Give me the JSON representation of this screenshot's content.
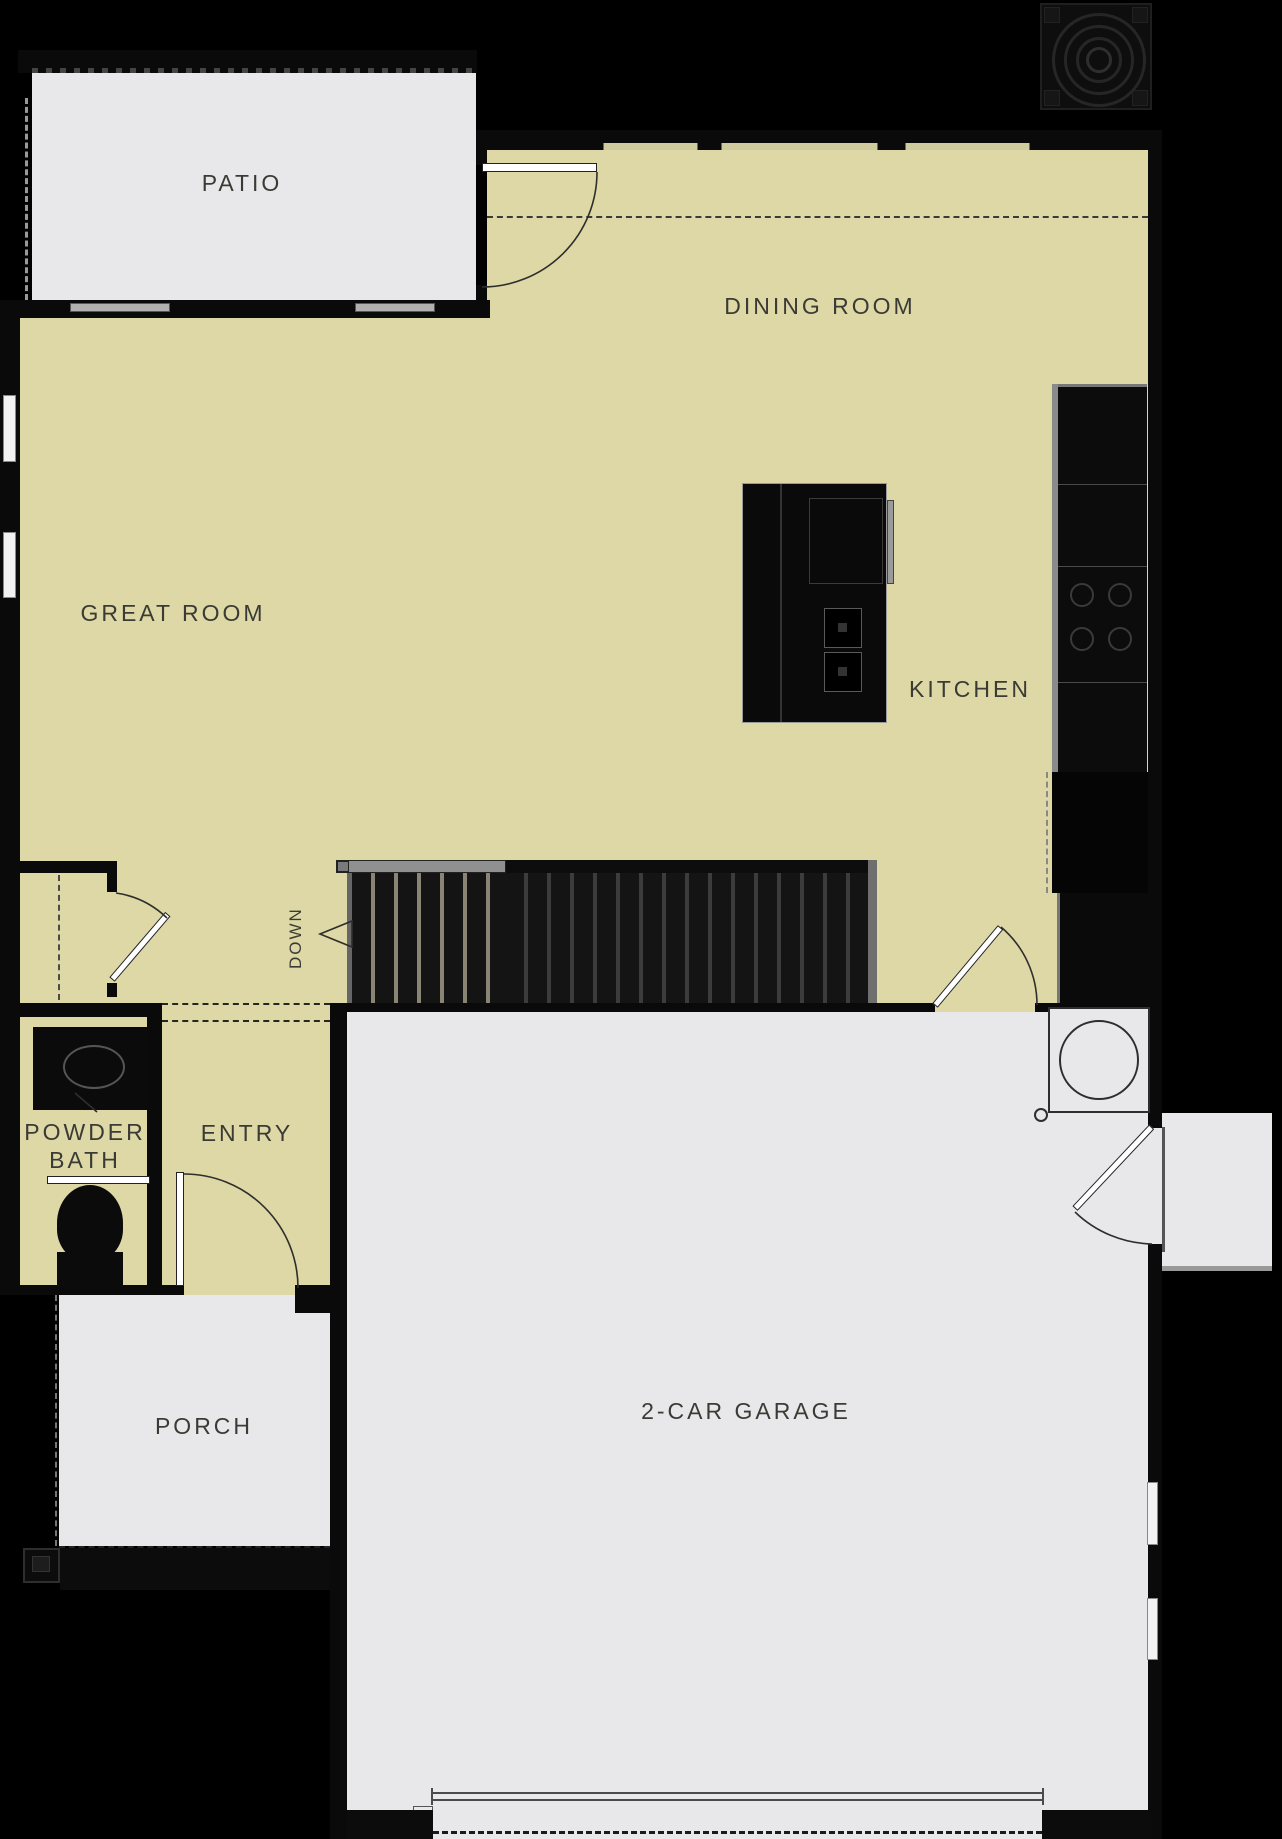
{
  "labels": {
    "patio": "PATIO",
    "dining_room": "DINING ROOM",
    "great_room": "GREAT ROOM",
    "kitchen": "KITCHEN",
    "powder_line1": "POWDER",
    "powder_line2": "BATH",
    "entry": "ENTRY",
    "porch": "PORCH",
    "garage": "2-CAR GARAGE",
    "stairs_down": "DOWN"
  },
  "colors": {
    "background": "#000000",
    "interior_floor": "#ddd8a5",
    "exterior_floor": "#e8e8ea",
    "wall": "#0a0a0a",
    "label_text": "#3b3b35",
    "door_leaf": "#ffffff",
    "handrail": "#909090"
  },
  "icons": {
    "compass_rose_icon": "concentric-rings-emblem",
    "stair_direction_arrow_icon": "left-pointing-triangle"
  }
}
